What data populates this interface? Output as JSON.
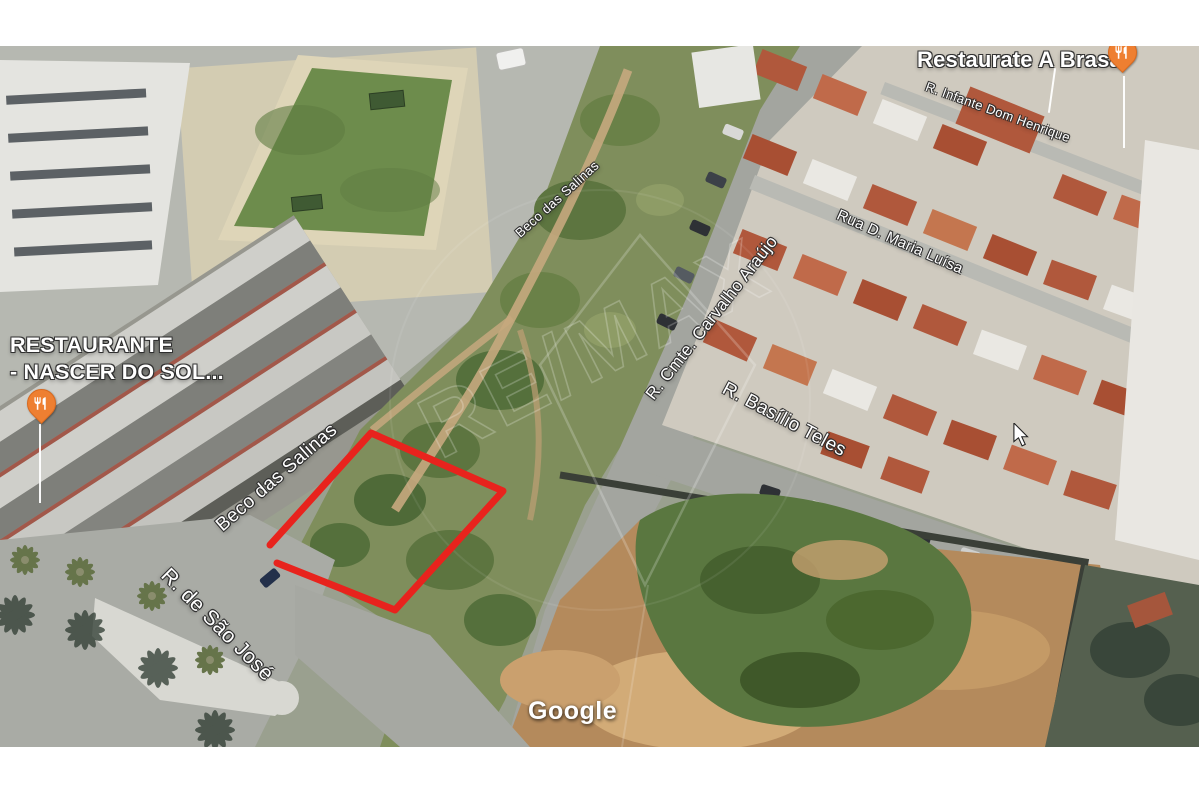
{
  "map": {
    "streets": {
      "beco_das_salinas_lower": "Beco das Salinas",
      "beco_das_salinas_upper": "Beco das Salinas",
      "cmte_carvalho_araujo": "R. Cmte. Carvalho Araújo",
      "basilio_teles": "R. Basílio Teles",
      "maria_luisa": "Rua D. Maria Luísa",
      "infante_dom_henrique": "R. Infante Dom Henrique",
      "sao_jose": "R. de São José"
    },
    "places": {
      "nascer_do_sol": {
        "line1": "RESTAURANTE",
        "line2": "- NASCER DO SOL...",
        "icon": "restaurant-pin"
      },
      "a_brasa": {
        "label": "Restaurate A Brasa",
        "icon": "restaurant-pin"
      }
    },
    "watermarks": {
      "google": "Google",
      "remax": "RE/MAX"
    },
    "colors": {
      "plot_outline": "#e8231d",
      "pin": "#ee7f31"
    }
  }
}
